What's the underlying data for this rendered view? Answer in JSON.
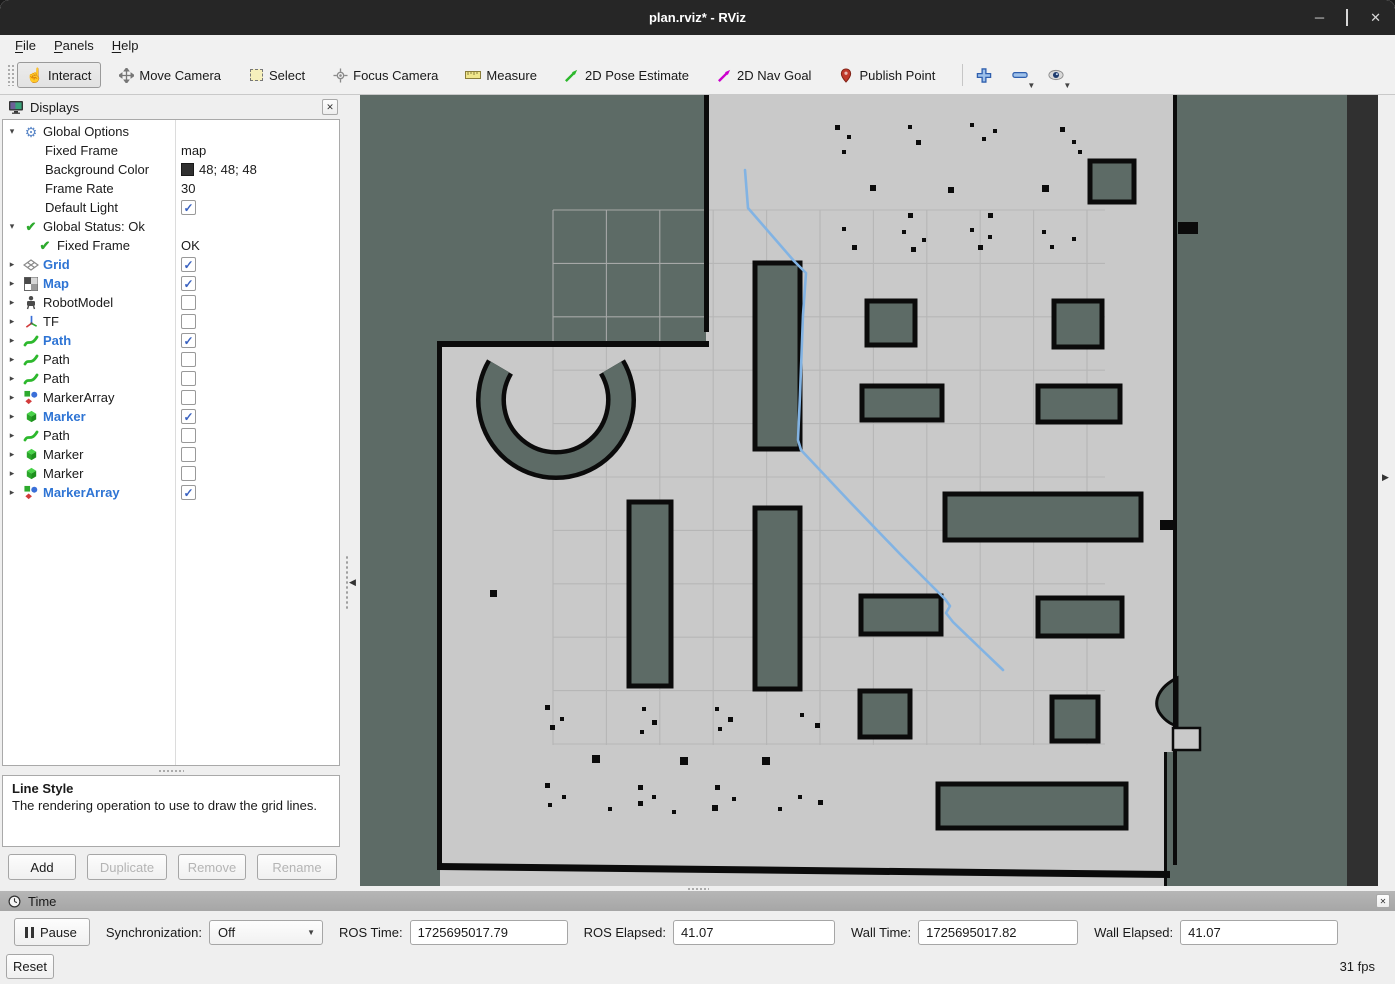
{
  "window": {
    "title": "plan.rviz* - RViz"
  },
  "menu": {
    "items": [
      "File",
      "Panels",
      "Help"
    ]
  },
  "toolbar": {
    "tools": [
      {
        "id": "interact",
        "label": "Interact",
        "icon": "hand-icon",
        "active": true
      },
      {
        "id": "move-camera",
        "label": "Move Camera",
        "icon": "move-icon",
        "active": false
      },
      {
        "id": "select",
        "label": "Select",
        "icon": "select-box-icon",
        "active": false
      },
      {
        "id": "focus-camera",
        "label": "Focus Camera",
        "icon": "focus-icon",
        "active": false
      },
      {
        "id": "measure",
        "label": "Measure",
        "icon": "ruler-icon",
        "active": false
      },
      {
        "id": "2d-pose-estimate",
        "label": "2D Pose Estimate",
        "icon": "green-arrow-icon",
        "active": false
      },
      {
        "id": "2d-nav-goal",
        "label": "2D Nav Goal",
        "icon": "magenta-arrow-icon",
        "active": false
      },
      {
        "id": "publish-point",
        "label": "Publish Point",
        "icon": "pin-icon",
        "active": false
      }
    ],
    "extra_buttons": [
      {
        "id": "add-tool",
        "icon": "plus-icon",
        "caret": false
      },
      {
        "id": "remove-tool",
        "icon": "minus-icon",
        "caret": true
      },
      {
        "id": "tool-properties",
        "icon": "eye-icon",
        "caret": true
      }
    ]
  },
  "displays_panel": {
    "title": "Displays",
    "rows": [
      {
        "exp": "down",
        "pad": 0,
        "icon": "gear-icon",
        "label": "Global Options",
        "blue": false,
        "value": null
      },
      {
        "exp": "",
        "pad": 22,
        "icon": null,
        "label": "Fixed Frame",
        "blue": false,
        "value": {
          "text": "map"
        }
      },
      {
        "exp": "",
        "pad": 22,
        "icon": null,
        "label": "Background Color",
        "blue": false,
        "value": {
          "swatch": "#303030",
          "text": "48; 48; 48"
        }
      },
      {
        "exp": "",
        "pad": 22,
        "icon": null,
        "label": "Frame Rate",
        "blue": false,
        "value": {
          "text": "30"
        }
      },
      {
        "exp": "",
        "pad": 22,
        "icon": null,
        "label": "Default Light",
        "blue": false,
        "value": {
          "checkbox": true
        }
      },
      {
        "exp": "down",
        "pad": 0,
        "icon": "check-icon",
        "label": "Global Status: Ok",
        "blue": false,
        "value": null
      },
      {
        "exp": "",
        "pad": 14,
        "icon": "check-icon",
        "label": "Fixed Frame",
        "blue": false,
        "value": {
          "text": "OK"
        }
      },
      {
        "exp": "right",
        "pad": 0,
        "icon": "grid-icon",
        "label": "Grid",
        "blue": true,
        "value": {
          "checkbox": true
        }
      },
      {
        "exp": "right",
        "pad": 0,
        "icon": "map-icon",
        "label": "Map",
        "blue": true,
        "value": {
          "checkbox": true
        }
      },
      {
        "exp": "right",
        "pad": 0,
        "icon": "robot-icon",
        "label": "RobotModel",
        "blue": false,
        "value": {
          "checkbox": false
        }
      },
      {
        "exp": "right",
        "pad": 0,
        "icon": "tf-icon",
        "label": "TF",
        "blue": false,
        "value": {
          "checkbox": false
        }
      },
      {
        "exp": "right",
        "pad": 0,
        "icon": "path-icon",
        "label": "Path",
        "blue": true,
        "value": {
          "checkbox": true
        }
      },
      {
        "exp": "right",
        "pad": 0,
        "icon": "path-icon",
        "label": "Path",
        "blue": false,
        "value": {
          "checkbox": false
        }
      },
      {
        "exp": "right",
        "pad": 0,
        "icon": "path-icon",
        "label": "Path",
        "blue": false,
        "value": {
          "checkbox": false
        }
      },
      {
        "exp": "right",
        "pad": 0,
        "icon": "markerarray-icon",
        "label": "MarkerArray",
        "blue": false,
        "value": {
          "checkbox": false
        }
      },
      {
        "exp": "right",
        "pad": 0,
        "icon": "marker-icon",
        "label": "Marker",
        "blue": true,
        "value": {
          "checkbox": true
        }
      },
      {
        "exp": "right",
        "pad": 0,
        "icon": "path-icon",
        "label": "Path",
        "blue": false,
        "value": {
          "checkbox": false
        }
      },
      {
        "exp": "right",
        "pad": 0,
        "icon": "marker-icon",
        "label": "Marker",
        "blue": false,
        "value": {
          "checkbox": false
        }
      },
      {
        "exp": "right",
        "pad": 0,
        "icon": "marker-icon",
        "label": "Marker",
        "blue": false,
        "value": {
          "checkbox": false
        }
      },
      {
        "exp": "right",
        "pad": 0,
        "icon": "markerarray-icon",
        "label": "MarkerArray",
        "blue": true,
        "value": {
          "checkbox": true
        }
      }
    ],
    "help_title": "Line Style",
    "help_text": "The rendering operation to use to draw the grid lines.",
    "buttons": [
      {
        "label": "Add",
        "enabled": true,
        "width": 68
      },
      {
        "label": "Duplicate",
        "enabled": false,
        "width": 80
      },
      {
        "label": "Remove",
        "enabled": false,
        "width": 68
      },
      {
        "label": "Rename",
        "enabled": false,
        "width": 80
      }
    ]
  },
  "time_panel": {
    "title": "Time",
    "pause_label": "Pause",
    "sync_label": "Synchronization:",
    "sync_value": "Off",
    "fields": [
      {
        "label": "ROS Time:",
        "value": "1725695017.79",
        "width": 158
      },
      {
        "label": "ROS Elapsed:",
        "value": "41.07",
        "width": 162
      },
      {
        "label": "Wall Time:",
        "value": "1725695017.82",
        "width": 160
      },
      {
        "label": "Wall Elapsed:",
        "value": "41.07",
        "width": 158
      }
    ],
    "reset_label": "Reset",
    "fps": "31 fps"
  },
  "colors": {
    "titlebar": "#262626",
    "accent_blue": "#2e74d4",
    "check_blue": "#3a62c0",
    "path_blue": "#82b3e3",
    "map_free": "#c9c9c9",
    "map_unknown": "#5d6b66",
    "map_obstacle": "#0b0b0b",
    "background_3d": "#303030",
    "grid_line": "#b3b3b3",
    "green_tool": "#2db82d",
    "magenta_tool": "#cc00cc",
    "pin_red": "#c0392b"
  },
  "viewport": {
    "grid": {
      "x0": 193,
      "y0": 115,
      "step": 53.4,
      "nx": 11,
      "ny": 11,
      "x_end": 745,
      "y_end": 650
    },
    "obstacles": [
      [
        395,
        168,
        45,
        186
      ],
      [
        730,
        66,
        44,
        41
      ],
      [
        507,
        206,
        48,
        44
      ],
      [
        694,
        206,
        48,
        46
      ],
      [
        502,
        291,
        80,
        34
      ],
      [
        678,
        291,
        82,
        36
      ],
      [
        585,
        399,
        196,
        46
      ],
      [
        269,
        407,
        42,
        184
      ],
      [
        395,
        413,
        45,
        181
      ],
      [
        501,
        501,
        80,
        38
      ],
      [
        678,
        503,
        84,
        38
      ],
      [
        500,
        596,
        50,
        46
      ],
      [
        692,
        602,
        46,
        44
      ],
      [
        578,
        689,
        188,
        44
      ]
    ],
    "dots": [
      [
        475,
        30,
        5
      ],
      [
        487,
        40,
        4
      ],
      [
        482,
        55,
        4
      ],
      [
        548,
        30,
        4
      ],
      [
        556,
        45,
        5
      ],
      [
        610,
        28,
        4
      ],
      [
        622,
        42,
        4
      ],
      [
        633,
        34,
        4
      ],
      [
        700,
        32,
        5
      ],
      [
        712,
        45,
        4
      ],
      [
        718,
        55,
        4
      ],
      [
        510,
        90,
        6
      ],
      [
        548,
        118,
        5
      ],
      [
        588,
        92,
        6
      ],
      [
        682,
        90,
        7
      ],
      [
        628,
        118,
        5
      ],
      [
        482,
        132,
        4
      ],
      [
        492,
        150,
        5
      ],
      [
        542,
        135,
        4
      ],
      [
        551,
        152,
        5
      ],
      [
        562,
        143,
        4
      ],
      [
        610,
        133,
        4
      ],
      [
        618,
        150,
        5
      ],
      [
        628,
        140,
        4
      ],
      [
        682,
        135,
        4
      ],
      [
        690,
        150,
        4
      ],
      [
        712,
        142,
        4
      ],
      [
        130,
        495,
        7
      ],
      [
        185,
        610,
        5
      ],
      [
        200,
        622,
        4
      ],
      [
        190,
        630,
        5
      ],
      [
        282,
        612,
        4
      ],
      [
        292,
        625,
        5
      ],
      [
        280,
        635,
        4
      ],
      [
        355,
        612,
        4
      ],
      [
        368,
        622,
        5
      ],
      [
        358,
        632,
        4
      ],
      [
        440,
        618,
        4
      ],
      [
        455,
        628,
        5
      ],
      [
        232,
        660,
        8
      ],
      [
        320,
        662,
        8
      ],
      [
        402,
        662,
        8
      ],
      [
        185,
        688,
        5
      ],
      [
        278,
        690,
        5
      ],
      [
        355,
        690,
        5
      ],
      [
        202,
        700,
        4
      ],
      [
        278,
        706,
        5
      ],
      [
        292,
        700,
        4
      ],
      [
        372,
        702,
        4
      ],
      [
        352,
        710,
        6
      ],
      [
        438,
        700,
        4
      ],
      [
        458,
        705,
        5
      ],
      [
        188,
        708,
        4
      ],
      [
        248,
        712,
        4
      ],
      [
        312,
        715,
        4
      ],
      [
        418,
        712,
        4
      ]
    ],
    "path_points": "385,75 388,113 434,166 446,178 443,220 440,300 438,345 441,355 490,407 540,459 585,504 590,511 586,518 593,527 620,553 643,575"
  }
}
